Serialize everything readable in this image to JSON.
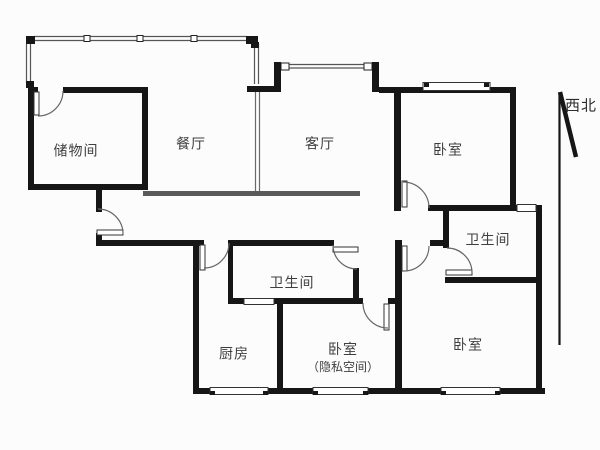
{
  "figure_type": "apartment-floor-plan",
  "rooms": {
    "storage": {
      "label": "储物间"
    },
    "dining": {
      "label": "餐厅"
    },
    "living": {
      "label": "客厅"
    },
    "bedroom_ne": {
      "label": "卧室"
    },
    "bath_right": {
      "label": "卫生间"
    },
    "bath_mid": {
      "label": "卫生间"
    },
    "kitchen": {
      "label": "厨房"
    },
    "bedroom_private": {
      "label": "卧室",
      "sublabel": "（隐私空间）"
    },
    "bedroom_se": {
      "label": "卧室"
    }
  },
  "compass": {
    "label": "西北"
  },
  "colors": {
    "wall": "#161616",
    "window_line": "#555555",
    "door_arc": "#666666",
    "beam": "#5a5a5a",
    "partition": "#6a6a6a",
    "label_text": "#3f3f3f",
    "background": "#fcfcfc"
  }
}
